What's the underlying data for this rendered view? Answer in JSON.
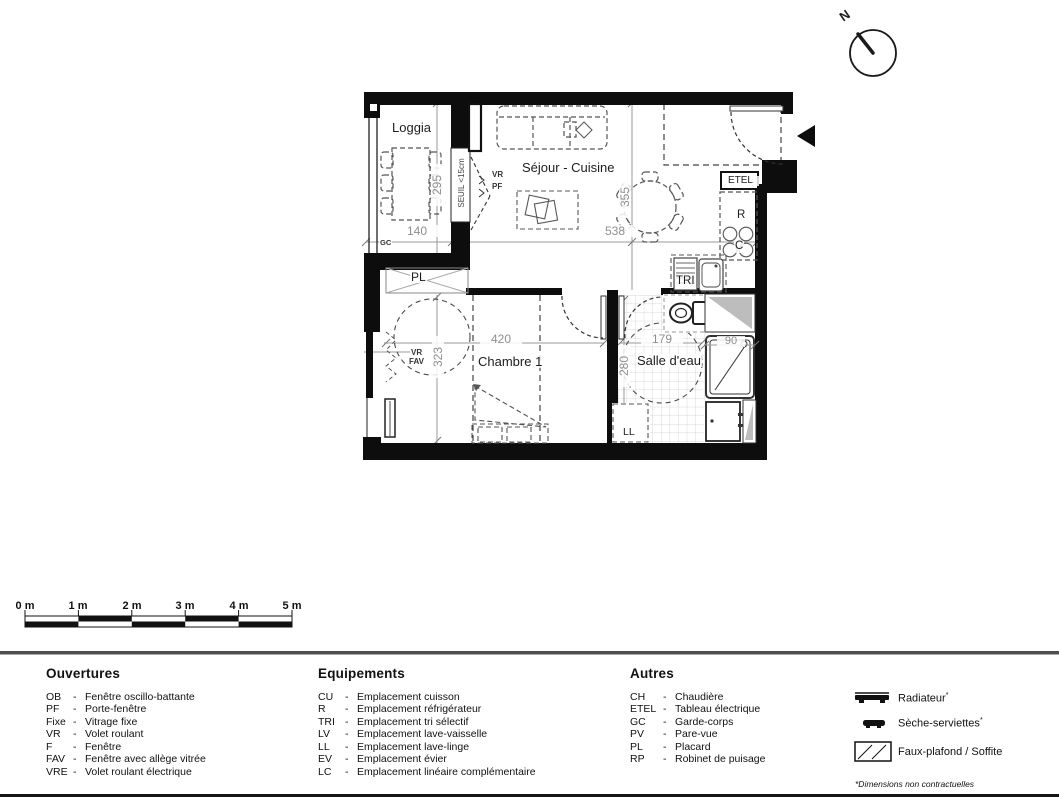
{
  "plan": {
    "rooms": {
      "loggia": "Loggia",
      "sejour": "Séjour - Cuisine",
      "chambre": "Chambre 1",
      "sde": "Salle d'eau"
    },
    "dims": {
      "loggia_w": "140",
      "loggia_h": "295",
      "sejour_w": "538",
      "sejour_h": "355",
      "chambre_w": "420",
      "chambre_h": "323",
      "sde_w": "179",
      "sde_h": "280",
      "douche": "90"
    },
    "annotations": {
      "seuil": "SEUIL <15cm",
      "vr_top": "VR",
      "pf": "PF",
      "vr_left": "VR",
      "fav": "FAV",
      "gc": "GC",
      "pl": "PL",
      "etel": "ETEL",
      "refrigerateur": "R",
      "cuisson": "C",
      "tri": "TRI",
      "lave_linge": "LL"
    }
  },
  "compass": {
    "north": "N"
  },
  "scale_bar": {
    "labels": [
      "0 m",
      "1 m",
      "2 m",
      "3 m",
      "4 m",
      "5 m"
    ]
  },
  "legend": {
    "dash": "-",
    "ouvertures": {
      "title": "Ouvertures",
      "items": [
        {
          "abbr": "OB",
          "label": "Fenêtre oscillo-battante"
        },
        {
          "abbr": "PF",
          "label": "Porte-fenêtre"
        },
        {
          "abbr": "Fixe",
          "label": "Vitrage fixe"
        },
        {
          "abbr": "VR",
          "label": "Volet roulant"
        },
        {
          "abbr": "F",
          "label": "Fenêtre"
        },
        {
          "abbr": "FAV",
          "label": "Fenêtre avec allège vitrée"
        },
        {
          "abbr": "VRE",
          "label": "Volet roulant électrique"
        }
      ]
    },
    "equipements": {
      "title": "Equipements",
      "items": [
        {
          "abbr": "CU",
          "label": "Emplacement cuisson"
        },
        {
          "abbr": "R",
          "label": "Emplacement réfrigérateur"
        },
        {
          "abbr": "TRI",
          "label": "Emplacement tri sélectif"
        },
        {
          "abbr": "LV",
          "label": "Emplacement lave-vaisselle"
        },
        {
          "abbr": "LL",
          "label": "Emplacement lave-linge"
        },
        {
          "abbr": "EV",
          "label": "Emplacement évier"
        },
        {
          "abbr": "LC",
          "label": "Emplacement linéaire complémentaire"
        }
      ]
    },
    "autres": {
      "title": "Autres",
      "items": [
        {
          "abbr": "CH",
          "label": "Chaudière"
        },
        {
          "abbr": "ETEL",
          "label": "Tableau électrique"
        },
        {
          "abbr": "GC",
          "label": "Garde-corps"
        },
        {
          "abbr": "PV",
          "label": "Pare-vue"
        },
        {
          "abbr": "PL",
          "label": "Placard"
        },
        {
          "abbr": "RP",
          "label": "Robinet de puisage"
        }
      ]
    },
    "symbols": {
      "radiateur": "Radiateur",
      "seche_serviettes": "Sèche-serviettes",
      "faux_plafond": "Faux-plafond / Soffite",
      "mark": "*"
    },
    "footnote": "*Dimensions non contractuelles"
  },
  "colors": {
    "wall": "#0d0d0d",
    "dim_line": "#9a9a9a",
    "furniture": "#555555",
    "tile_grid": "#d8d8d8",
    "soffit_gray": "#bdbdbd"
  }
}
